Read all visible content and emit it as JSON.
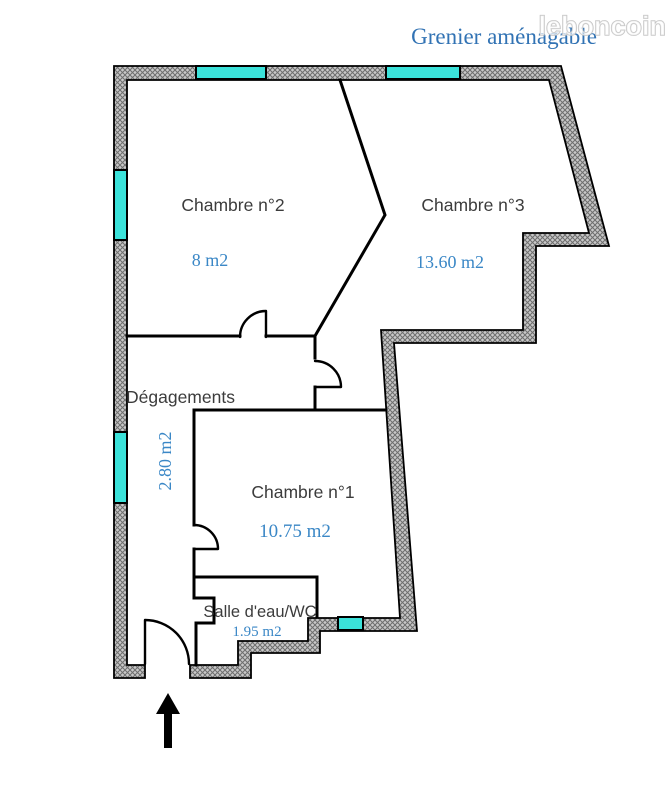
{
  "watermark": {
    "brand": "leboncoin"
  },
  "plan": {
    "attic_label": "Grenier aménagable",
    "rooms": [
      {
        "name": "Chambre n°2",
        "area": "8 m2"
      },
      {
        "name": "Chambre n°3",
        "area": "13.60 m2"
      },
      {
        "name": "Chambre n°1",
        "area": "10.75 m2"
      },
      {
        "name": "Dégagements",
        "area": "2.80 m2"
      },
      {
        "name": "Salle d'eau/WC",
        "area": "1.95 m2"
      }
    ]
  },
  "colors": {
    "window_glass": "#3BE2DA",
    "area_text": "#3A87C6",
    "attic_text": "#3273B4",
    "room_text": "#3C3C3C",
    "wall_fill": "#C8C8C8",
    "wall_hatch": "#6E6E6E",
    "wall_outline": "#000000",
    "interior_wall": "#000000",
    "watermark_fill": "#FFFFFF",
    "watermark_outline": "#BDBDBD"
  }
}
